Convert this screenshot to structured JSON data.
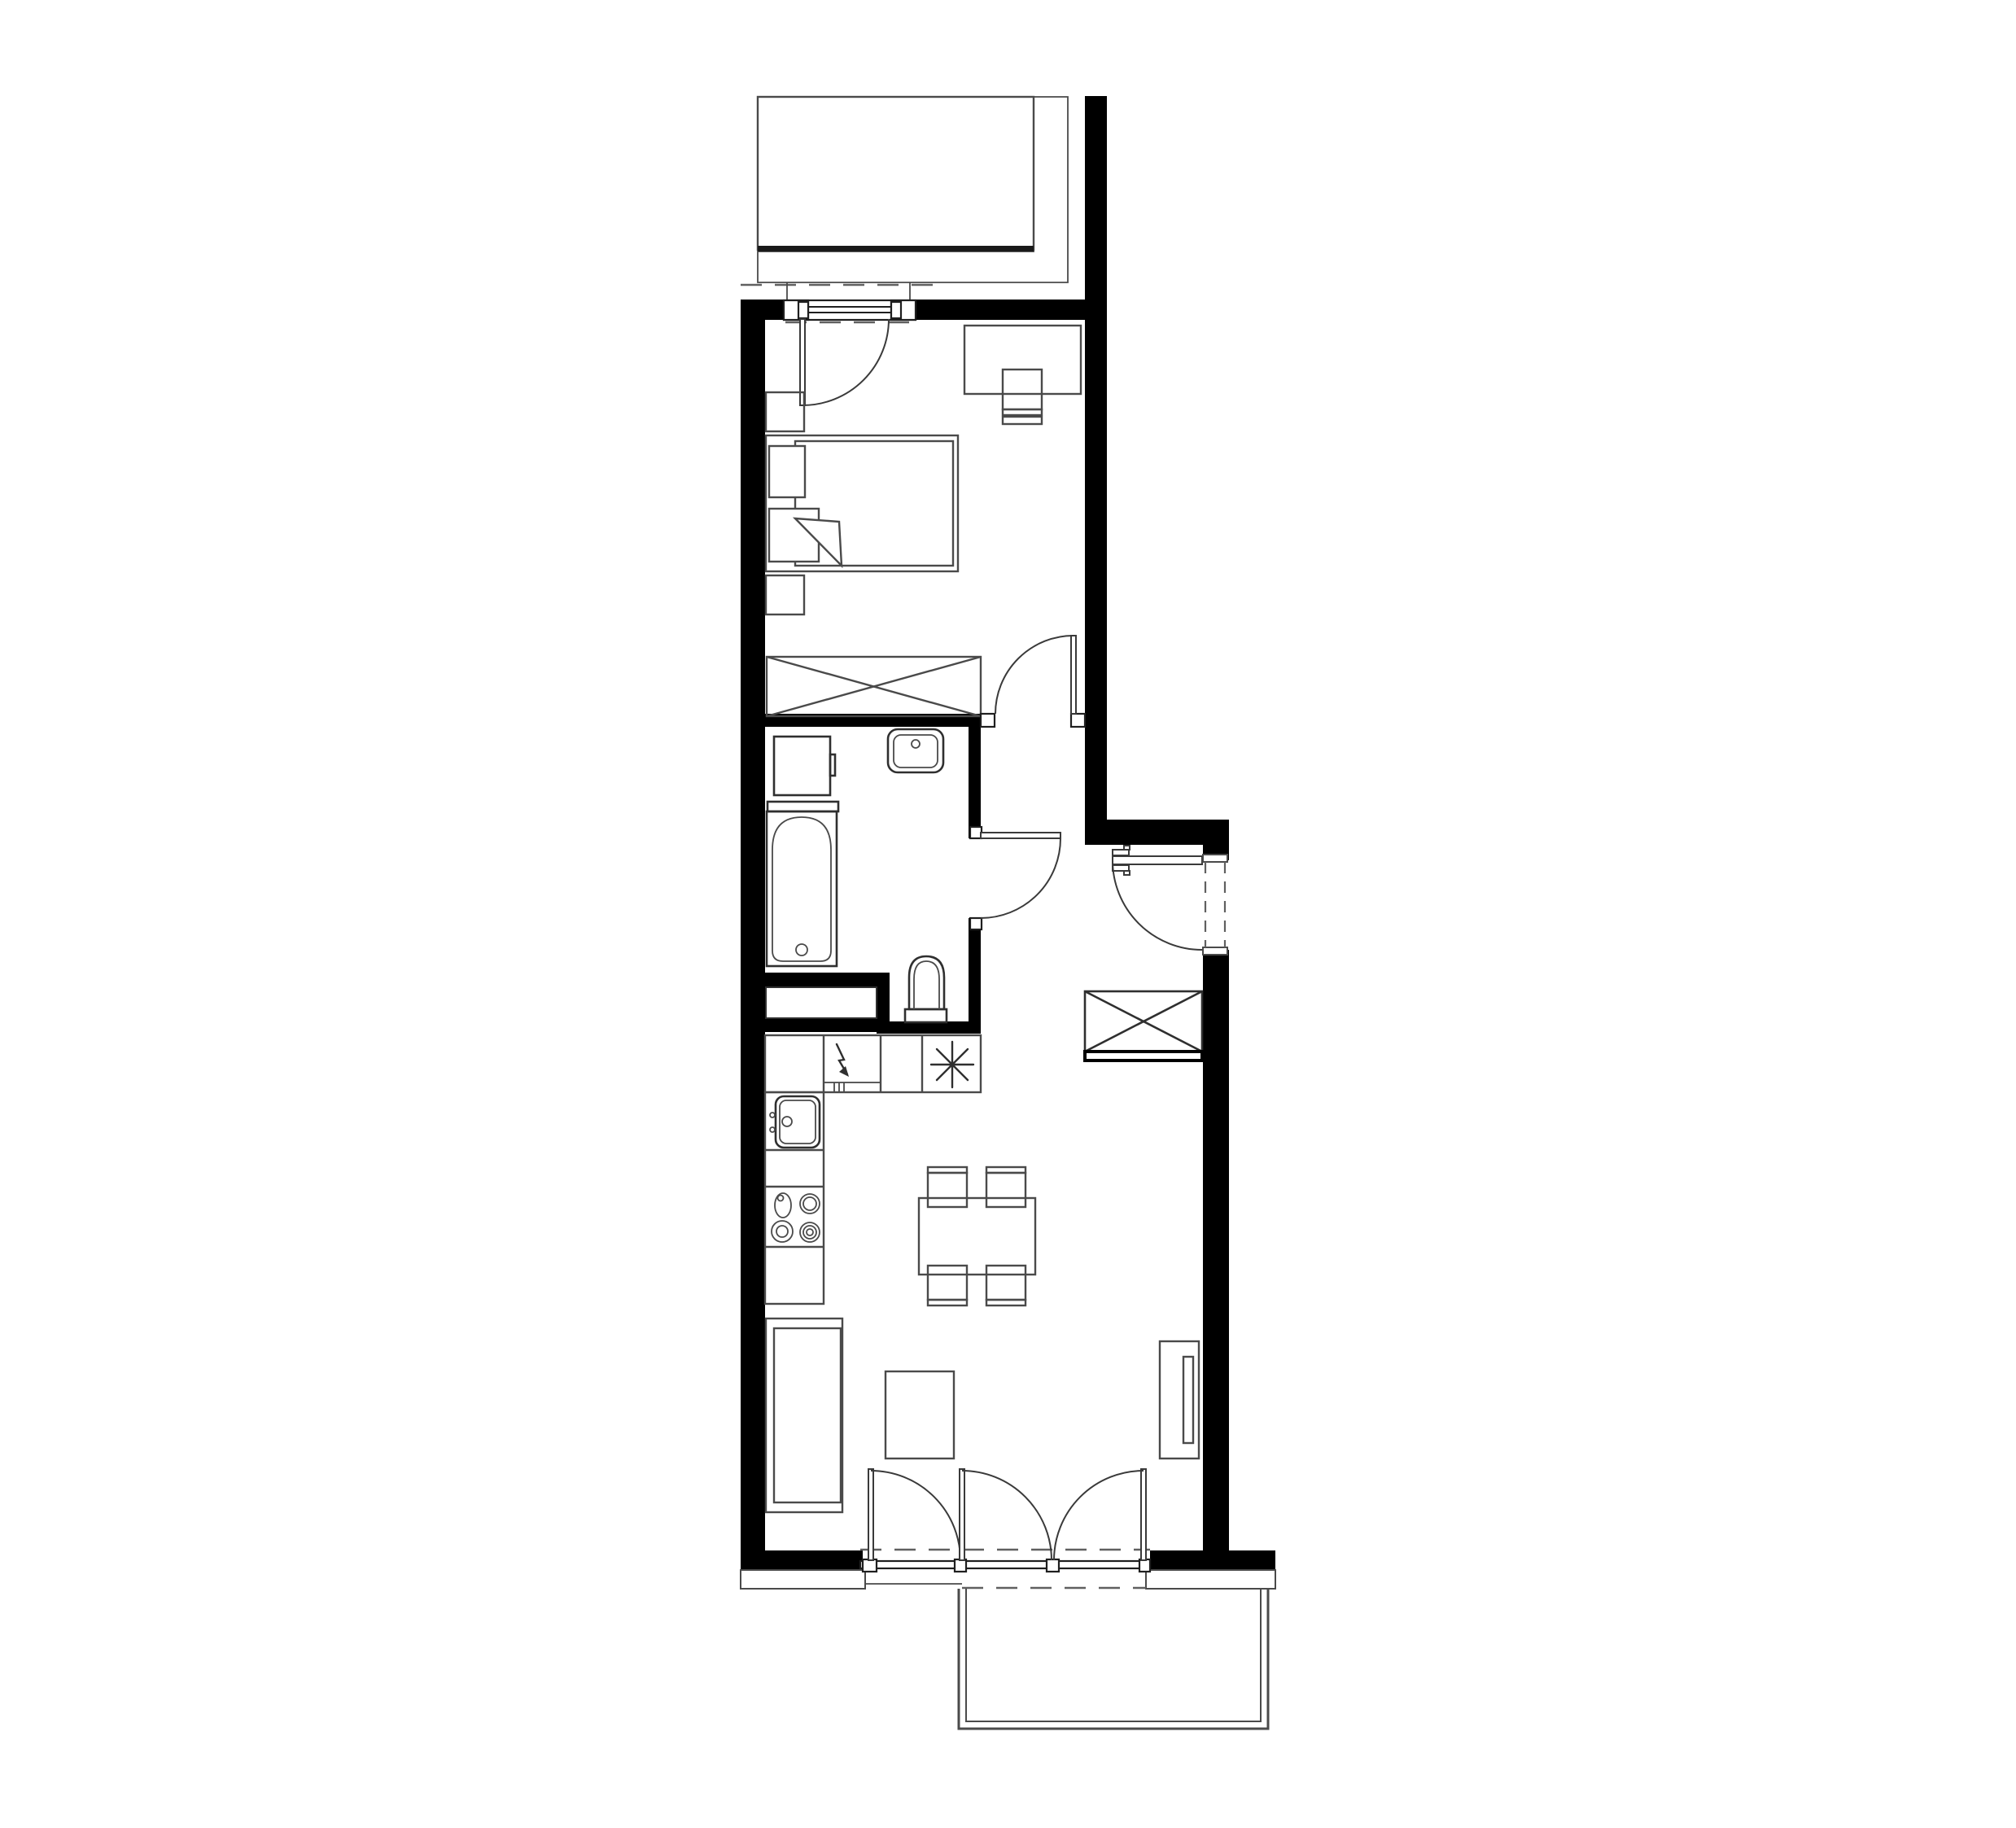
{
  "document": {
    "kind": "architectural-floor-plan",
    "title": "One-bedroom apartment floor plan",
    "visible_text": []
  },
  "colors": {
    "background": "#ffffff",
    "wall_fill": "#000000",
    "furniture_line": "#4a4a4a",
    "fixture_line": "#2f2f2f",
    "frame_line": "#1f1f1f",
    "door_line": "#3a3a3a",
    "dashed_line": "#606060",
    "platform_edge": "#1a1a1a",
    "stipple_dot": "#111111"
  },
  "rooms": [
    {
      "name": "balcony-top",
      "features": [
        "platform-slab",
        "stippled-gravel-band"
      ]
    },
    {
      "name": "bedroom",
      "features": [
        "balcony-door",
        "desk",
        "desk-chair",
        "double-bed",
        "two-nightstands",
        "wardrobe-crossed"
      ]
    },
    {
      "name": "bathroom",
      "features": [
        "washing-machine",
        "washbasin",
        "bathtub",
        "toilet",
        "duct-shaft",
        "swing-door"
      ]
    },
    {
      "name": "hallway",
      "features": [
        "entrance-door",
        "built-in-wardrobe-crossed"
      ]
    },
    {
      "name": "kitchen",
      "features": [
        "counter-run",
        "appliance-lightning-symbol",
        "cooker-asterisk-symbol",
        "kitchen-sink",
        "hob-four-burners"
      ]
    },
    {
      "name": "living-room",
      "features": [
        "sofa",
        "armchair",
        "dining-table",
        "four-chairs",
        "tv-unit",
        "triple-balcony-door"
      ]
    },
    {
      "name": "balcony-bottom",
      "features": [
        "railing-double-line"
      ]
    }
  ],
  "symbols_legend": [
    {
      "icon": "crossed-rectangle-icon",
      "meaning": "wardrobe / built-in storage"
    },
    {
      "icon": "quarter-arc-icon",
      "meaning": "door swing"
    },
    {
      "icon": "dashed-line-icon",
      "meaning": "opening above / threshold"
    },
    {
      "icon": "lightning-arrow-icon",
      "meaning": "electrical appliance point"
    },
    {
      "icon": "asterisk-icon",
      "meaning": "cooker / connection point"
    },
    {
      "icon": "stipple-band-icon",
      "meaning": "balcony finish strip"
    }
  ]
}
